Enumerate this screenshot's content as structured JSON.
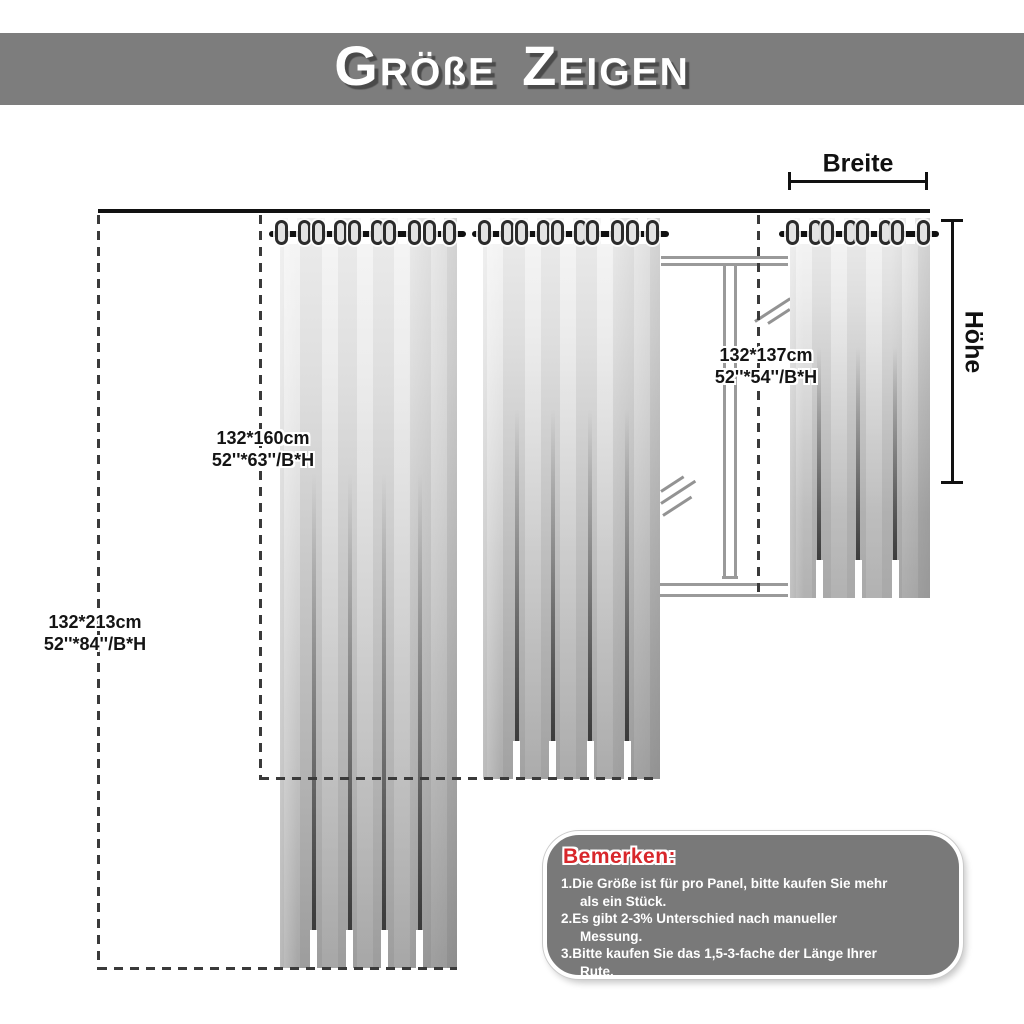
{
  "banner": {
    "title": "GRÖßE ZEIGEN"
  },
  "measurements": {
    "width_label": "Breite",
    "height_label": "Höhe"
  },
  "curtains": [
    {
      "name": "panel-213",
      "size_cm": "132*213cm",
      "size_in": "52''*84''/B*H",
      "grommets": 10
    },
    {
      "name": "panel-160",
      "size_cm": "132*160cm",
      "size_in": "52''*63''/B*H",
      "grommets": 10
    },
    {
      "name": "panel-137",
      "size_cm": "132*137cm",
      "size_in": "52''*54''/B*H",
      "grommets": 8
    }
  ],
  "notes": {
    "title": "Bemerken:",
    "items": [
      [
        "1.Die Größe ist für pro Panel, bitte kaufen Sie mehr",
        "als ein Stück."
      ],
      [
        "2.Es gibt 2-3% Unterschied nach manueller",
        "Messung."
      ],
      [
        "3.Bitte kaufen Sie das 1,5-3-fache der Länge Ihrer",
        "Rute."
      ]
    ]
  },
  "colors": {
    "banner_bg": "#7d7d7d",
    "notes_bg": "#797979",
    "notes_title": "#d8272b",
    "dash_line": "#3a3a3a",
    "window_line": "#9a9a9a",
    "curtain_light": "#ececec",
    "curtain_dark": "#9d9d9d"
  }
}
